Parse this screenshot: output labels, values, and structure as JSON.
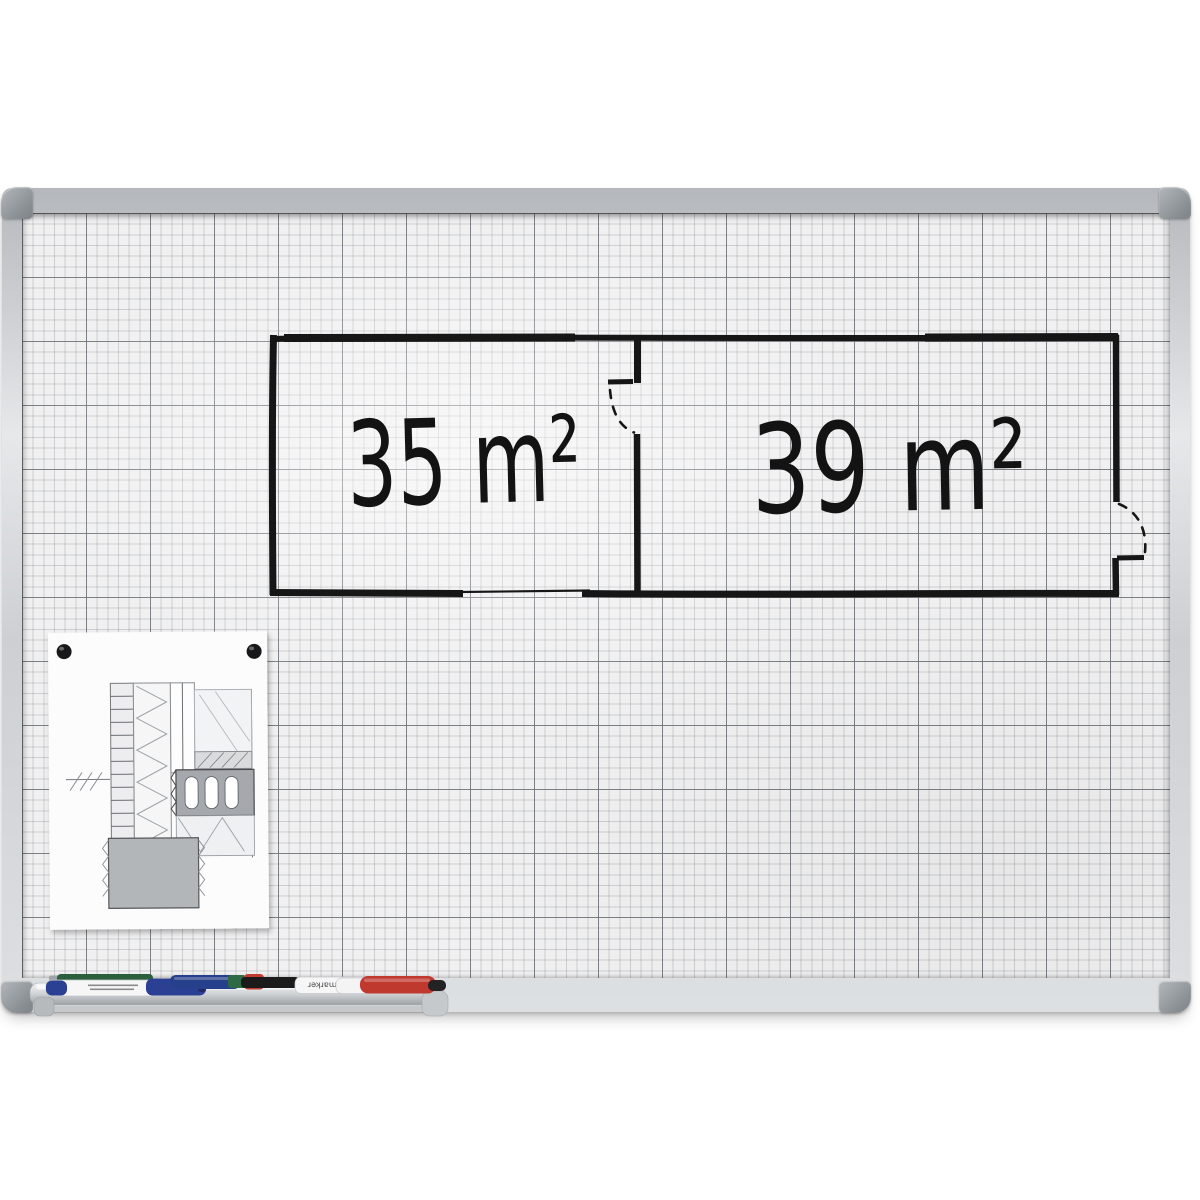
{
  "floor_plan": {
    "rooms": [
      {
        "area_label": "35 m²"
      },
      {
        "area_label": "39 m²"
      }
    ],
    "door_count": 2
  },
  "pinned_paper": {
    "pin_count": 2,
    "pin_color": "#18181a",
    "paper_color": "#fcfcfd"
  },
  "markers": {
    "brand_label": "Planmarker",
    "items": [
      {
        "name": "green-marker",
        "color": "#2c5f3d"
      },
      {
        "name": "white-marker-blue-cap",
        "color": "#2b3f93"
      },
      {
        "name": "blue-marker",
        "color": "#27408b"
      },
      {
        "name": "white-marker-black-cap",
        "color": "#1b1b1b"
      },
      {
        "name": "red-marker",
        "color": "#c0392f"
      }
    ]
  },
  "palette": {
    "frame": "#cdd0d3",
    "corner_cap": "#8e9398",
    "surface": "#f0f0f1",
    "grid_minor": "#c7cacd",
    "grid_major": "#787c82",
    "ink": "#161616",
    "tray": "#ced1d4"
  }
}
